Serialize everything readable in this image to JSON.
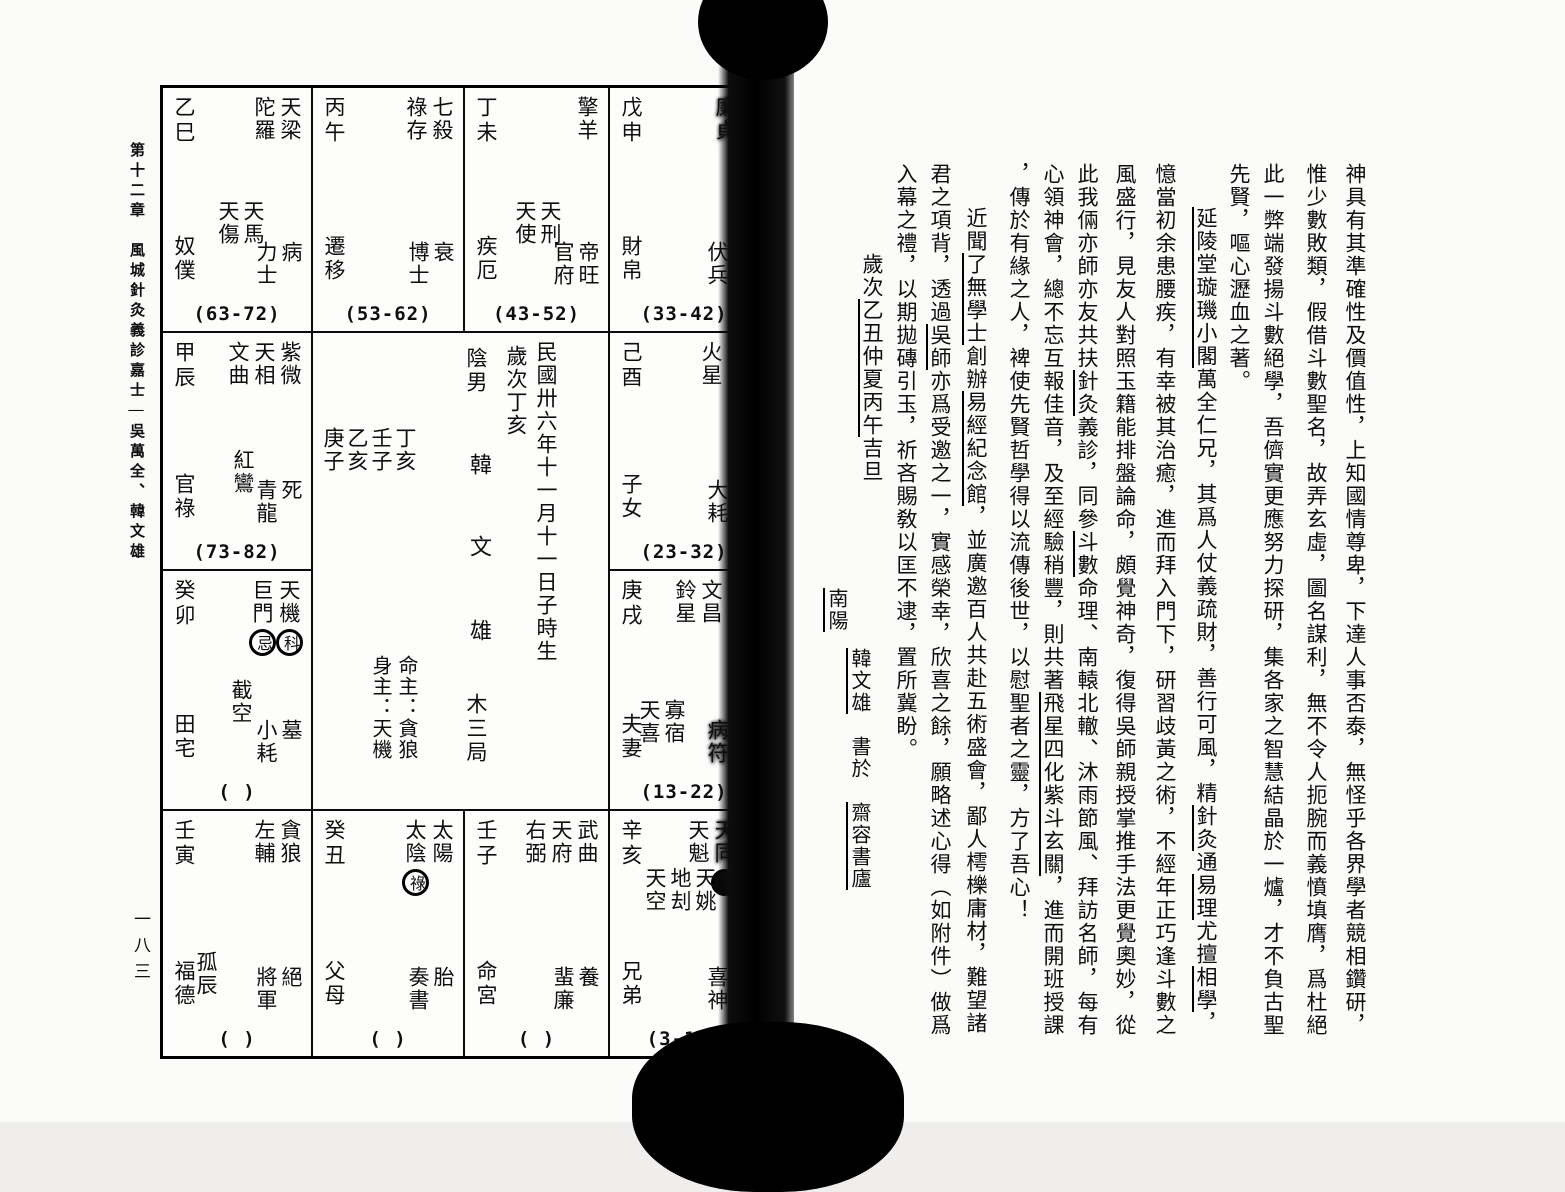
{
  "left_page": {
    "page_number": "一八三",
    "margin_title": "第十二章　風城針灸義診嘉士—吳萬全、韓文雄",
    "chart": {
      "center": {
        "gender_label": "陰男",
        "name_chars": [
          "韓",
          "文",
          "雄"
        ],
        "bureau": "木三局",
        "birth_date": "民國卅六年十一月十一日子時生",
        "year_line": "歲次丁亥",
        "pillars": [
          "丁亥",
          "壬子",
          "乙亥",
          "庚子"
        ],
        "ming_zhu": "命主：貪狼",
        "shen_zhu": "身主：天機"
      },
      "palaces": [
        {
          "branch": "si",
          "gz": "乙巳",
          "stars": [
            {
              "t": "天梁"
            },
            {
              "t": "陀羅"
            }
          ],
          "minors": [
            "天馬",
            "天傷"
          ],
          "palace": "奴僕",
          "stage": "病",
          "god": "力士",
          "range": "(63-72)"
        },
        {
          "branch": "wu",
          "gz": "丙午",
          "stars": [
            {
              "t": "七殺"
            },
            {
              "t": "祿存"
            }
          ],
          "minors": [],
          "palace": "遷移",
          "stage": "衰",
          "god": "博士",
          "range": "(53-62)"
        },
        {
          "branch": "wei",
          "gz": "丁未",
          "stars": [
            {
              "t": "擎羊"
            }
          ],
          "minors": [
            "天刑",
            "天使"
          ],
          "palace": "疾厄",
          "stage": "帝旺",
          "god": "官府",
          "range": "(43-52)"
        },
        {
          "branch": "shen",
          "gz": "戊申",
          "stars": [
            {
              "t": "廉貞",
              "smudged": true
            }
          ],
          "minors": [],
          "palace": "財帛",
          "stage": "臨官",
          "stage_smudged": true,
          "god": "伏兵",
          "range": "(33-42)"
        },
        {
          "branch": "chen",
          "gz": "甲辰",
          "stars": [
            {
              "t": "紫微"
            },
            {
              "t": "天相"
            },
            {
              "t": "文曲"
            }
          ],
          "minors": [
            "紅鸞"
          ],
          "palace": "官祿",
          "stage": "死",
          "god": "青龍",
          "range": "(73-82)"
        },
        {
          "branch": "you",
          "gz": "己酉",
          "stars": [
            {
              "t": "天鉞"
            },
            {
              "t": "火星"
            }
          ],
          "minors": [],
          "palace": "子女",
          "stage": "冠帶",
          "stage_smudged": true,
          "god": "大耗",
          "range": "(23-32)"
        },
        {
          "branch": "mao",
          "gz": "癸卯",
          "stars": [
            {
              "t": "天機",
              "mark": "科"
            },
            {
              "t": "巨門",
              "mark": "忌"
            }
          ],
          "minors": [
            "截空"
          ],
          "palace": "田宅",
          "stage": "墓",
          "god": "小耗",
          "range": "(  )"
        },
        {
          "branch": "xu",
          "gz": "庚戌",
          "stars": [
            {
              "t": "破軍"
            },
            {
              "t": "文昌"
            },
            {
              "t": "鈴星"
            }
          ],
          "minors": [
            "寡宿",
            "天喜"
          ],
          "palace": "夫妻",
          "stage": "沐浴",
          "stage_smudged": true,
          "god": "病符",
          "god_smudged": true,
          "range": "(13-22)"
        },
        {
          "branch": "yin",
          "gz": "壬寅",
          "stars": [
            {
              "t": "貪狼"
            },
            {
              "t": "左輔"
            }
          ],
          "minors": [
            "孤辰"
          ],
          "palace": "福德",
          "stage": "絕",
          "god": "將軍",
          "range": "(  )"
        },
        {
          "branch": "chou",
          "gz": "癸丑",
          "stars": [
            {
              "t": "太陽"
            },
            {
              "t": "太陰",
              "mark": "祿"
            }
          ],
          "minors": [],
          "palace": "父母",
          "stage": "胎",
          "god": "奏書",
          "range": "(  )"
        },
        {
          "branch": "zi",
          "gz": "壬子",
          "stars": [
            {
              "t": "武曲"
            },
            {
              "t": "天府"
            },
            {
              "t": "右弼"
            }
          ],
          "minors": [],
          "palace": "命宮",
          "stage": "養",
          "god": "蜚廉",
          "range": "(  )"
        },
        {
          "branch": "hai",
          "gz": "辛亥",
          "stars": [
            {
              "t": "天同",
              "mark": "權",
              "inked": true,
              "smudged": true
            },
            {
              "t": "天魁"
            }
          ],
          "minors": [
            "天姚",
            "地刦",
            "天空"
          ],
          "palace": "兄弟",
          "stage": "長生",
          "stage_smudged": true,
          "god": "喜神",
          "range": "(3-12)"
        }
      ]
    }
  },
  "right_page": {
    "page_number": "一八二",
    "columns": [
      {
        "segments": [
          {
            "t": "神具有其準確性及價值性，上知國情尊卑，下達人事否泰，無怪乎各界學者競相鑽研，"
          }
        ]
      },
      {
        "segments": [
          {
            "t": "惟少數敗類，假借斗數聖名，故弄玄虛，圖名謀利，無不令人扼腕而義憤填膺，爲杜絕"
          }
        ]
      },
      {
        "segments": [
          {
            "t": "此一弊端發揚斗數絕學，吾儕實更應努力探研，集各家之智慧結晶於一爐，才不負古聖"
          }
        ]
      },
      {
        "segments": [
          {
            "t": "先賢，嘔心瀝血之著。"
          }
        ]
      },
      {
        "indent": true,
        "segments": [
          {
            "t": "延陵堂璇璣小閣",
            "em": true
          },
          {
            "t": "萬全仁兄，其爲人仗義疏財，善行可風，精"
          },
          {
            "t": "針灸",
            "em": true
          },
          {
            "t": "通"
          },
          {
            "t": "易理",
            "em": true
          },
          {
            "t": "尤擅"
          },
          {
            "t": "相學",
            "em": true
          },
          {
            "t": "，"
          }
        ]
      },
      {
        "segments": [
          {
            "t": "憶當初余患腰疾，有幸被其治癒，進而拜入門下，研習歧黃之術，不經年正巧逢斗數之"
          }
        ]
      },
      {
        "segments": [
          {
            "t": "風盛行，見友人對照玉籍能排盤論命，頗覺神奇，復得吳師親授掌推手法更覺奧妙，從"
          }
        ]
      },
      {
        "segments": [
          {
            "t": "此我倆亦師亦友共扶"
          },
          {
            "t": "針灸",
            "em": true
          },
          {
            "t": "義診，同參"
          },
          {
            "t": "斗數",
            "em": true
          },
          {
            "t": "命理、南轅北轍、沐雨節風、拜訪名師，每有"
          }
        ]
      },
      {
        "segments": [
          {
            "t": "心領神會，總不忘互報佳音，及至經驗稍豐，則共著"
          },
          {
            "t": "飛星四化紫斗玄關",
            "em": true
          },
          {
            "t": "，進而開班授課"
          }
        ]
      },
      {
        "segments": [
          {
            "t": "，傳於有緣之人，裨使先賢哲學得以流傳後世，以慰聖者之靈，方了吾心！"
          }
        ]
      },
      {
        "indent": true,
        "segments": [
          {
            "t": "近聞"
          },
          {
            "t": "了無學士",
            "em": true
          },
          {
            "t": "創辦"
          },
          {
            "t": "易經紀念館",
            "em": true
          },
          {
            "t": "，並廣邀百人共赴五術盛會，鄙人樗櫟庸材，難望諸"
          }
        ]
      },
      {
        "segments": [
          {
            "t": "君之項背，透過"
          },
          {
            "t": "吳師",
            "em": true
          },
          {
            "t": "亦爲受邀之一，實感榮幸，欣喜之餘，願略述心得（如附件）做爲"
          }
        ]
      },
      {
        "segments": [
          {
            "t": "入幕之禮，以期拋磚引玉，祈吝賜敎以匡不逮，置所冀盼。"
          }
        ]
      }
    ],
    "date_line": {
      "segments": [
        {
          "t": "歲次"
        },
        {
          "t": "乙丑",
          "em": true
        },
        {
          "t": "仲夏",
          "em": true
        },
        {
          "t": "丙午",
          "em": true
        },
        {
          "t": "吉旦"
        }
      ]
    },
    "signature": {
      "place": {
        "segments": [
          {
            "t": "南陽",
            "em": true
          }
        ]
      },
      "name_line": {
        "segments": [
          {
            "t": "韓文雄",
            "em": true
          },
          {
            "t": "　書於　"
          },
          {
            "t": "齋容書廬",
            "em": true
          }
        ]
      }
    }
  }
}
